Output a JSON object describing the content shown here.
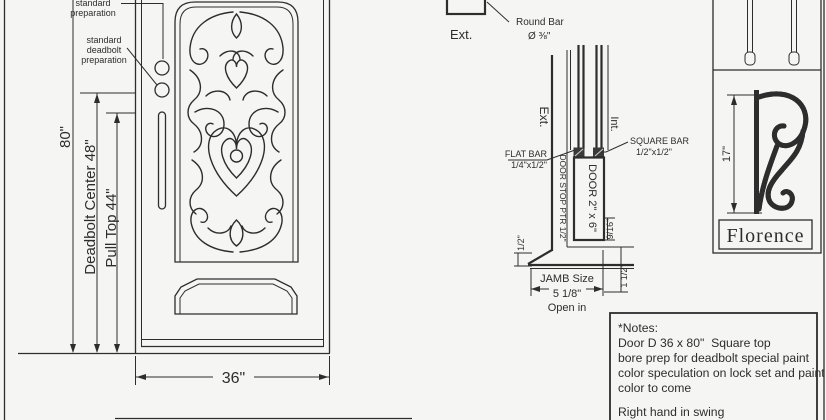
{
  "drawing": {
    "door": {
      "callout_standard_prep": [
        "standard",
        "preparation"
      ],
      "callout_deadbolt_prep": [
        "standard",
        "deadbolt",
        "preparation"
      ],
      "dim_height": "80\"",
      "dim_deadbolt": "Deadbolt Center 48\"",
      "dim_pull": "Pull Top 44\"",
      "dim_width": "36\""
    },
    "round_bar_detail": {
      "ext": "Ext.",
      "label_line1": "Round Bar",
      "label_line2": "Ø ⅜\""
    },
    "jamb_section": {
      "ext": "Ext.",
      "int": "Int.",
      "flat_bar_line1": "FLAT BAR",
      "flat_bar_line2": "1/4\"x1/2\"",
      "square_bar_line1": "SQUARE BAR",
      "square_bar_line2": "1/2\"x1/2\"",
      "door_stop": "DOOR STOP PTR 1/2\"",
      "door_profile": "DOOR 2\" x 6\"",
      "dim_half": "1/2\"",
      "dim_916": "9/16\"",
      "dim_1half": "1 1/2\"",
      "jamb_line1": "JAMB Size",
      "jamb_line2": "5 1/8\"",
      "jamb_line3": "Open in"
    },
    "handle": {
      "dim": "17\"",
      "name": "Florence"
    },
    "notes": [
      "*Notes:",
      "Door D 36 x 80\"  Square top",
      "bore prep for deadbolt special paint",
      "color speculation on lock set and paint",
      "color to come",
      "Right hand in swing"
    ]
  }
}
